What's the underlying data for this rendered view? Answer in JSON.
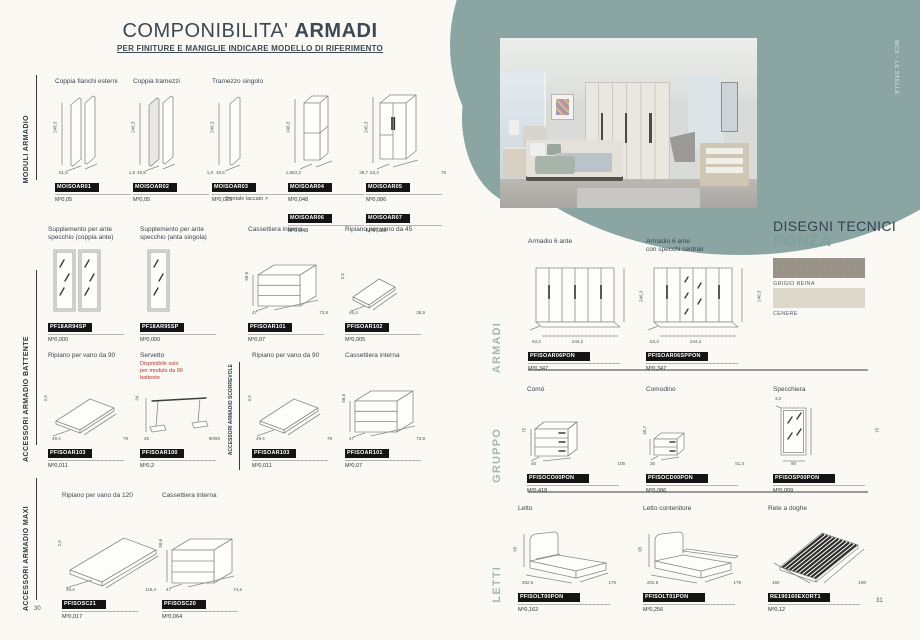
{
  "pages": {
    "left_number": "30",
    "right_number": "31"
  },
  "brand_tab": "MCS - LE STELLE",
  "colors": {
    "accent_teal": "#8ba5a2",
    "chip_black": "#141414",
    "warning_red": "#b5352e",
    "heading_slate": "#3c4852",
    "section_label_teal": "#a3bab4"
  },
  "left": {
    "title_regular": "COMPONIBILITA'",
    "title_bold": "ARMADI",
    "subtitle": "PER FINITURE E MANIGLIE INDICARE MODELLO DI RIFERIMENTO",
    "note": "frontale laccato >",
    "sidebar": [
      "MODULI ARMADIO",
      "ACCESSORI ARMADIO BATTENTE",
      "ACCESSORI ARMADIO MAXI"
    ],
    "s1": {
      "items": [
        {
          "label": "Coppia fianchi esterni",
          "code": "MOISOAR01",
          "value": "M³0,05",
          "dims": {
            "h": "248,3",
            "a": "51,5",
            "b": "1,8"
          }
        },
        {
          "label": "Coppia tramezzi",
          "code": "MOISOAR02",
          "value": "M³0,05",
          "dims": {
            "h": "246,3",
            "a": "49,5",
            "b": "1,8"
          }
        },
        {
          "label": "Tramezzo singolo",
          "code": "MOISOAR03",
          "value": "M³0,025",
          "dims": {
            "h": "246,3",
            "a": "49,5",
            "b": "1,8"
          }
        },
        {
          "label": "",
          "code": "MOISOAR04",
          "value": "M³0,048",
          "code2": "MOISOAR06",
          "value2": "M³0,048",
          "dims": {
            "h": "246,3",
            "a": "53,3",
            "b": "38,7"
          }
        },
        {
          "label": "",
          "code": "MOISOAR05",
          "value": "M³0,086",
          "code2": "MOISOAR07",
          "value2": "M³0,086",
          "dims": {
            "h": "245,3",
            "a": "53,3",
            "b": "79"
          }
        }
      ]
    },
    "s2": {
      "divider_label": "ACCESSORI ARMADIO SCORREVOLE",
      "row1": [
        {
          "label": "Supplemento per ante\nspecchio (coppia ante)",
          "code": "PF18AR94SP",
          "value": "M³0,000"
        },
        {
          "label": "Supplemento per ante\nspecchio (anta singola)",
          "code": "PF18AR95SP",
          "value": "M³0,000"
        },
        {
          "label": "Cassettiera interna",
          "code": "PFISOAR101",
          "value": "M³0,07",
          "dims": {
            "h": "58,6",
            "a": "47",
            "b": "73,9"
          }
        },
        {
          "label": "Ripiano per vano da 45",
          "code": "PFISOAR102",
          "value": "M³0,005",
          "dims": {
            "h": "2,5",
            "a": "46,4",
            "b": "38,9"
          }
        }
      ],
      "row2": [
        {
          "label": "Ripiano per vano da 90",
          "code": "PFISOAR103",
          "value": "M³0,011",
          "dims": {
            "h": "2,5",
            "a": "49,4",
            "b": "79"
          }
        },
        {
          "label": "Servetto",
          "warning": "Disponibile solo\nper modulo da 90\nbattente",
          "code": "PFISOAR100",
          "value": "M³0,2",
          "dims": {
            "h": "34",
            "a": "25",
            "b": "90/93"
          }
        },
        {
          "label": "Ripiano per vano da 90",
          "code": "PFISOAR103",
          "value": "M³0,011",
          "dims": {
            "h": "2,5",
            "a": "49,4",
            "b": "79"
          }
        },
        {
          "label": "Cassettiera interna",
          "code": "PFISOAR101",
          "value": "M³0,07",
          "dims": {
            "h": "58,6",
            "a": "47",
            "b": "73,9"
          }
        }
      ]
    },
    "s3": {
      "items": [
        {
          "label": "Ripiano per vano da 120",
          "code": "PFISOSC21",
          "value": "M³0,017",
          "dims": {
            "h": "2,5",
            "a": "49,4",
            "b": "118,4"
          }
        },
        {
          "label": "Cassettiera interna",
          "code": "PFISOSC20",
          "value": "M³0,064",
          "dims": {
            "h": "58,6",
            "a": "47",
            "b": "74,6"
          }
        }
      ]
    }
  },
  "right": {
    "heading_top": "DISEGNI TECNICI",
    "heading_name": "PONZA",
    "swatches": [
      {
        "label": "GRIGIO REINA"
      },
      {
        "label": "CENERE"
      }
    ],
    "sections_labels": [
      "ARMADI",
      "GRUPPO",
      "LETTI"
    ],
    "armadi": {
      "items": [
        {
          "label": "Armadio 6 ante",
          "code": "PFISOAR06PON",
          "value": "M³0,347",
          "dims": {
            "h": "246,3",
            "a": "63,3",
            "b": "244,2"
          }
        },
        {
          "label": "Armadio 6 ante\ncon specchi centrali",
          "code": "PFISOAR06SPPON",
          "value": "M³0,347",
          "dims": {
            "h": "246,3",
            "a": "63,3",
            "b": "244,2"
          }
        }
      ]
    },
    "gruppo": {
      "items": [
        {
          "label": "Comò",
          "code": "PFISOCO00PON",
          "value": "M³0,418",
          "dims": {
            "h": "75",
            "a": "46",
            "b": "105"
          }
        },
        {
          "label": "Comodino",
          "code": "PFISOCD00PON",
          "value": "M³0,086",
          "dims": {
            "h": "40,7",
            "a": "36",
            "b": "51,4"
          }
        },
        {
          "label": "Specchiera",
          "code": "PFISOSP00PON",
          "value": "M³0,009",
          "dims": {
            "h": "75",
            "a": "3,2",
            "b": "90"
          }
        }
      ]
    },
    "letti": {
      "items": [
        {
          "label": "Letto",
          "code": "PFISOLT00PON",
          "value": "M³0,162",
          "dims": {
            "h": "95",
            "a": "202,5",
            "b": "179"
          }
        },
        {
          "label": "Letto contenitore",
          "code": "PFISOLT01PON",
          "value": "M³0,256",
          "dims": {
            "h": "95",
            "a": "202,5",
            "b": "179"
          }
        },
        {
          "label": "Rete a doghe",
          "code": "RE190160EXORT1",
          "value": "M³0,12",
          "dims": {
            "a": "160",
            "b": "190"
          }
        }
      ]
    }
  }
}
